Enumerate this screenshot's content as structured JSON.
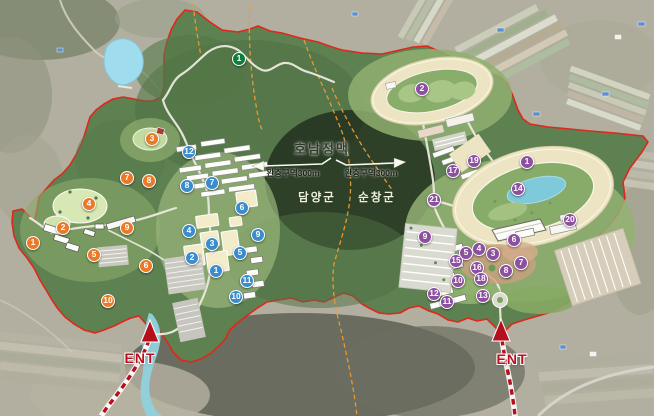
{
  "labels": {
    "mountain_range": "호남정맥",
    "buffer_left": "완충구역300m",
    "buffer_right": "완충구역300m",
    "county_left": "담양군",
    "county_right": "순창군",
    "entrance_left": "ENT",
    "entrance_right": "ENT"
  },
  "colors": {
    "orange": "#ea7a28",
    "blue": "#3b8ccc",
    "purple": "#8d4f9f",
    "green": "#0e7d3c",
    "boundary_red": "#e0271c",
    "county_line_orange": "#ef9b2f",
    "ent_red": "#c00d1d",
    "forest_green": "#5e8152",
    "track_sand": "#ece4c3",
    "pond_blue": "#7ec9da",
    "lake_blue": "#9fdcee"
  },
  "markers": [
    {
      "g": "green",
      "n": "1",
      "x": 239,
      "y": 59
    },
    {
      "g": "orange",
      "n": "3",
      "x": 152,
      "y": 139
    },
    {
      "g": "orange",
      "n": "7",
      "x": 127,
      "y": 178
    },
    {
      "g": "orange",
      "n": "8",
      "x": 149,
      "y": 181
    },
    {
      "g": "orange",
      "n": "4",
      "x": 89,
      "y": 204
    },
    {
      "g": "orange",
      "n": "2",
      "x": 63,
      "y": 228
    },
    {
      "g": "orange",
      "n": "9",
      "x": 127,
      "y": 228
    },
    {
      "g": "orange",
      "n": "1",
      "x": 33,
      "y": 243
    },
    {
      "g": "orange",
      "n": "5",
      "x": 94,
      "y": 255
    },
    {
      "g": "orange",
      "n": "6",
      "x": 146,
      "y": 266
    },
    {
      "g": "orange",
      "n": "10",
      "x": 108,
      "y": 301
    },
    {
      "g": "blue",
      "n": "12",
      "x": 189,
      "y": 152
    },
    {
      "g": "blue",
      "n": "7",
      "x": 212,
      "y": 183
    },
    {
      "g": "blue",
      "n": "8",
      "x": 187,
      "y": 186
    },
    {
      "g": "blue",
      "n": "6",
      "x": 242,
      "y": 208
    },
    {
      "g": "blue",
      "n": "4",
      "x": 189,
      "y": 231
    },
    {
      "g": "blue",
      "n": "9",
      "x": 258,
      "y": 235
    },
    {
      "g": "blue",
      "n": "3",
      "x": 212,
      "y": 244
    },
    {
      "g": "blue",
      "n": "5",
      "x": 240,
      "y": 253
    },
    {
      "g": "blue",
      "n": "2",
      "x": 192,
      "y": 258
    },
    {
      "g": "blue",
      "n": "1",
      "x": 216,
      "y": 271
    },
    {
      "g": "blue",
      "n": "11",
      "x": 247,
      "y": 281
    },
    {
      "g": "blue",
      "n": "10",
      "x": 236,
      "y": 297
    },
    {
      "g": "purple",
      "n": "2",
      "x": 422,
      "y": 89
    },
    {
      "g": "purple",
      "n": "1",
      "x": 527,
      "y": 162
    },
    {
      "g": "purple",
      "n": "19",
      "x": 474,
      "y": 161
    },
    {
      "g": "purple",
      "n": "17",
      "x": 453,
      "y": 171
    },
    {
      "g": "purple",
      "n": "14",
      "x": 518,
      "y": 189
    },
    {
      "g": "purple",
      "n": "21",
      "x": 434,
      "y": 200
    },
    {
      "g": "purple",
      "n": "20",
      "x": 570,
      "y": 220
    },
    {
      "g": "purple",
      "n": "9",
      "x": 425,
      "y": 237
    },
    {
      "g": "purple",
      "n": "6",
      "x": 514,
      "y": 240
    },
    {
      "g": "purple",
      "n": "4",
      "x": 479,
      "y": 249
    },
    {
      "g": "purple",
      "n": "5",
      "x": 466,
      "y": 253
    },
    {
      "g": "purple",
      "n": "3",
      "x": 493,
      "y": 254
    },
    {
      "g": "purple",
      "n": "15",
      "x": 456,
      "y": 261
    },
    {
      "g": "purple",
      "n": "7",
      "x": 521,
      "y": 263
    },
    {
      "g": "purple",
      "n": "16",
      "x": 477,
      "y": 268
    },
    {
      "g": "purple",
      "n": "8",
      "x": 506,
      "y": 271
    },
    {
      "g": "purple",
      "n": "18",
      "x": 481,
      "y": 279
    },
    {
      "g": "purple",
      "n": "10",
      "x": 458,
      "y": 281
    },
    {
      "g": "purple",
      "n": "12",
      "x": 434,
      "y": 294
    },
    {
      "g": "purple",
      "n": "13",
      "x": 483,
      "y": 296
    },
    {
      "g": "purple",
      "n": "11",
      "x": 447,
      "y": 302
    }
  ]
}
